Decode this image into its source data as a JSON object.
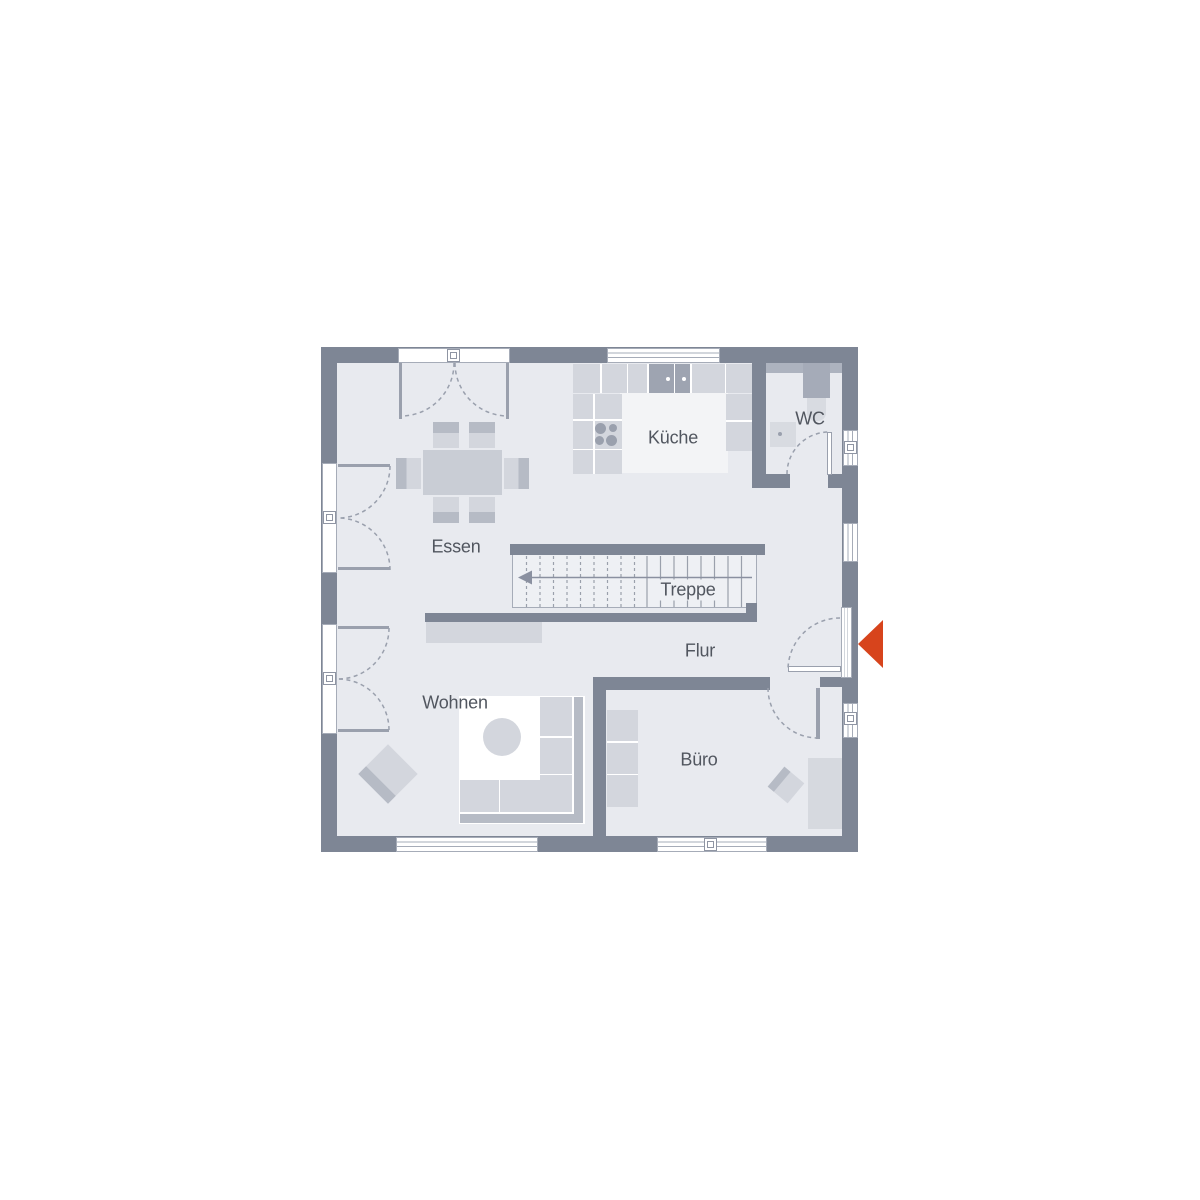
{
  "floorplan": {
    "rooms": {
      "kueche": {
        "label": "Küche"
      },
      "wc": {
        "label": "WC"
      },
      "essen": {
        "label": "Essen"
      },
      "treppe": {
        "label": "Treppe"
      },
      "flur": {
        "label": "Flur"
      },
      "wohnen": {
        "label": "Wohnen"
      },
      "buero": {
        "label": "Büro"
      }
    },
    "entrance": {
      "marker_icon": "entrance-arrow",
      "marker_shape": "left-pointing-triangle",
      "color": "#d7441c"
    },
    "colors": {
      "wall": "#7e8695",
      "floor": "#e8eaef",
      "kitchen_floor": "#f3f4f6",
      "furniture": "#d3d6dd",
      "furniture_accent": "#b6bbc5",
      "fixture_dark": "#9aa0ad",
      "line": "#9aa0ad",
      "label_text": "#51565f",
      "background": "#ffffff"
    }
  }
}
